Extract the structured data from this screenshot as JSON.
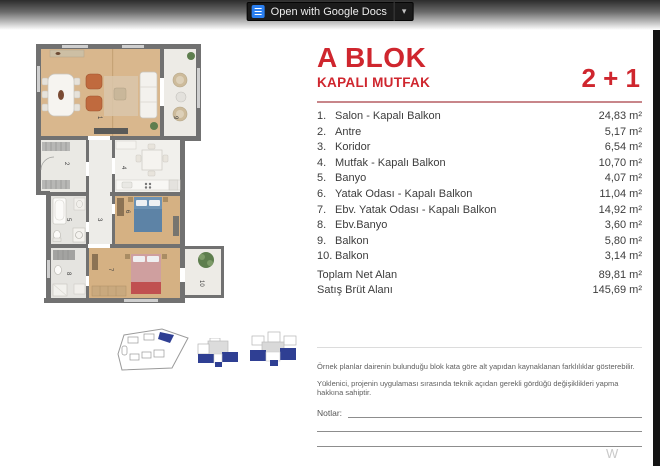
{
  "toolbar": {
    "open_label": "Open with Google Docs",
    "caret": "▾"
  },
  "colors": {
    "accent": "#cf262e",
    "key_blue": "#2f3f93",
    "wall": "#717171"
  },
  "header": {
    "title": "A BLOK",
    "subtitle": "KAPALI MUTFAK",
    "unit_type": "2 + 1"
  },
  "rooms": [
    {
      "no": "1.",
      "name": "Salon - Kapalı Balkon",
      "area": "24,83 m²"
    },
    {
      "no": "2.",
      "name": "Antre",
      "area": "5,17 m²"
    },
    {
      "no": "3.",
      "name": "Koridor",
      "area": "6,54 m²"
    },
    {
      "no": "4.",
      "name": "Mutfak - Kapalı Balkon",
      "area": "10,70 m²"
    },
    {
      "no": "5.",
      "name": "Banyo",
      "area": "4,07 m²"
    },
    {
      "no": "6.",
      "name": "Yatak Odası - Kapalı Balkon",
      "area": "11,04 m²"
    },
    {
      "no": "7.",
      "name": "Ebv. Yatak Odası - Kapalı Balkon",
      "area": "14,92 m²"
    },
    {
      "no": "8.",
      "name": "Ebv.Banyo",
      "area": "3,60 m²"
    },
    {
      "no": "9.",
      "name": "Balkon",
      "area": "5,80 m²"
    },
    {
      "no": "10.",
      "name": "Balkon",
      "area": "3,14 m²"
    }
  ],
  "totals": [
    {
      "label": "Toplam Net Alan",
      "area": "89,81 m²"
    },
    {
      "label": "Satış Brüt Alanı",
      "area": "145,69 m²"
    }
  ],
  "disclaimers": [
    "Örnek planlar dairenin bulunduğu blok kata göre alt yapıdan kaynaklanan farklılıklar gösterebilir.",
    "Yüklenici, projenin uygulaması sırasında teknik açıdan gerekli gördüğü değişiklikleri yapma hakkına sahiptir."
  ],
  "notes_label": "Notlar:",
  "watermark": "W",
  "floor_plan": {
    "labels": [
      "1",
      "2",
      "3",
      "4",
      "5",
      "6",
      "7",
      "8",
      "9",
      "10"
    ]
  }
}
